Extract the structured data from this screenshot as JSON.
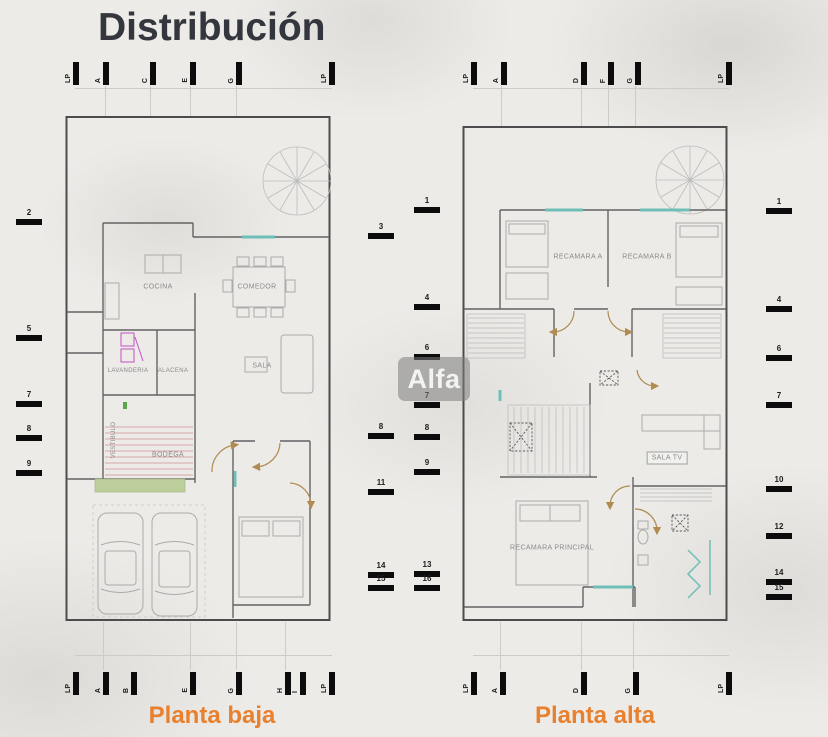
{
  "title": "Distribución",
  "watermark": "Alfa",
  "captions": {
    "left": "Planta baja",
    "right": "Planta alta"
  },
  "colors": {
    "title": "#33363c",
    "accent_orange": "#e8802e",
    "tick_black": "#0c0c0c",
    "window_teal": "#6fbfb7",
    "door_swing_tan": "#b08b52",
    "garden_green": "#bccf9b",
    "laundry_magenta": "#c44fc4",
    "stair_pink": "#d9a4a4"
  },
  "plans": [
    {
      "name": "Planta baja",
      "rooms": {
        "cocina": "COCINA",
        "comedor": "COMEDOR",
        "sala": "SALA",
        "lavanderia": "LAVANDERIA",
        "alacena": "ALACENA",
        "vestibulo": "VESTIBULO",
        "bodega": "BODEGA"
      },
      "grid_top": [
        "LP",
        "A",
        "C",
        "E",
        "G",
        "LP"
      ],
      "grid_bottom": [
        "LP",
        "A",
        "B",
        "E",
        "G",
        "H",
        "I",
        "LP"
      ],
      "grid_left": [
        "2",
        "5",
        "7",
        "8",
        "9"
      ],
      "grid_right": [
        "3",
        "8",
        "11",
        "14",
        "15"
      ]
    },
    {
      "name": "Planta alta",
      "rooms": {
        "recamara_a": "RECAMARA A",
        "recamara_b": "RECAMARA B",
        "sala_tv": "SALA TV",
        "recamara_principal": "RECAMARA PRINCIPAL"
      },
      "grid_top": [
        "LP",
        "A",
        "D",
        "F",
        "G",
        "LP"
      ],
      "grid_bottom": [
        "LP",
        "A",
        "D",
        "G",
        "LP"
      ],
      "grid_left": [
        "1",
        "4",
        "6",
        "7",
        "8",
        "9",
        "13",
        "16"
      ],
      "grid_right": [
        "1",
        "4",
        "6",
        "7",
        "10",
        "12",
        "14",
        "15"
      ]
    }
  ]
}
